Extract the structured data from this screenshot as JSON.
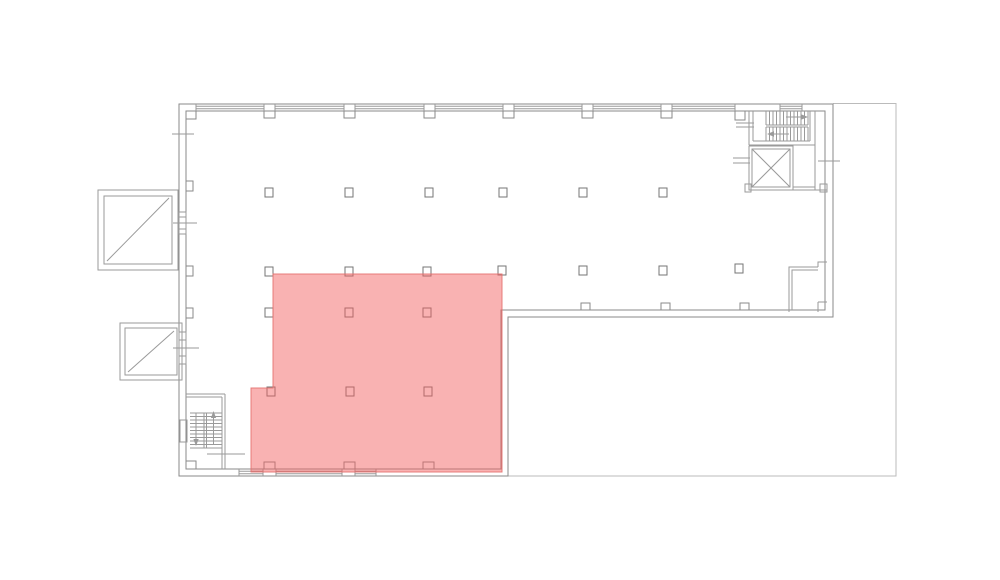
{
  "canvas": {
    "width_px": 1000,
    "height_px": 580,
    "background": "#ffffff"
  },
  "palette": {
    "wall_line": "#8a8a8a",
    "detail_line": "#9a9a9a",
    "terrace_line": "#bbbbbb",
    "column_stroke": "#757575",
    "column_fill": "#ffffff",
    "highlight_fill": "#f25f5f",
    "highlight_fill_opacity": 0.48,
    "highlight_stroke": "#e4716e",
    "highlight_stroke_opacity": 0.9
  },
  "highlight_zone": {
    "shape": "polygon",
    "points_px": [
      [
        273,
        274
      ],
      [
        502,
        274
      ],
      [
        502,
        472
      ],
      [
        251,
        472
      ],
      [
        251,
        388
      ],
      [
        273,
        388
      ]
    ]
  },
  "columns": {
    "size_px": [
      8,
      9
    ],
    "positions_px": [
      [
        265,
        188
      ],
      [
        345,
        188
      ],
      [
        425,
        188
      ],
      [
        499,
        188
      ],
      [
        579,
        188
      ],
      [
        659,
        188
      ],
      [
        265,
        267
      ],
      [
        345,
        267
      ],
      [
        423,
        267
      ],
      [
        498,
        266
      ],
      [
        579,
        266
      ],
      [
        659,
        266
      ],
      [
        735,
        264
      ],
      [
        265,
        308
      ],
      [
        345,
        308
      ],
      [
        423,
        308
      ],
      [
        267,
        387
      ],
      [
        346,
        387
      ],
      [
        424,
        387
      ]
    ]
  },
  "windows": {
    "top_wall_bands_x": [
      [
        196,
        264
      ],
      [
        275,
        344
      ],
      [
        355,
        424
      ],
      [
        435,
        503
      ],
      [
        514,
        582
      ],
      [
        593,
        661
      ],
      [
        672,
        735
      ],
      [
        780,
        802
      ]
    ],
    "bottom_wall_bands_x": [
      [
        239,
        263
      ],
      [
        276,
        342
      ],
      [
        355,
        376
      ]
    ]
  },
  "piers": {
    "top_wall_x": [
      264,
      344,
      424,
      503,
      582,
      661
    ],
    "bottom_wall_x": [
      264,
      344,
      423
    ],
    "middle_wall_x": [
      581,
      661,
      740
    ],
    "left_wall_y": [
      181,
      266,
      308
    ],
    "jog_rects_px": [
      [
        735,
        111,
        10,
        9
      ],
      [
        186,
        111,
        10,
        8
      ],
      [
        186,
        461,
        10,
        8
      ]
    ]
  }
}
